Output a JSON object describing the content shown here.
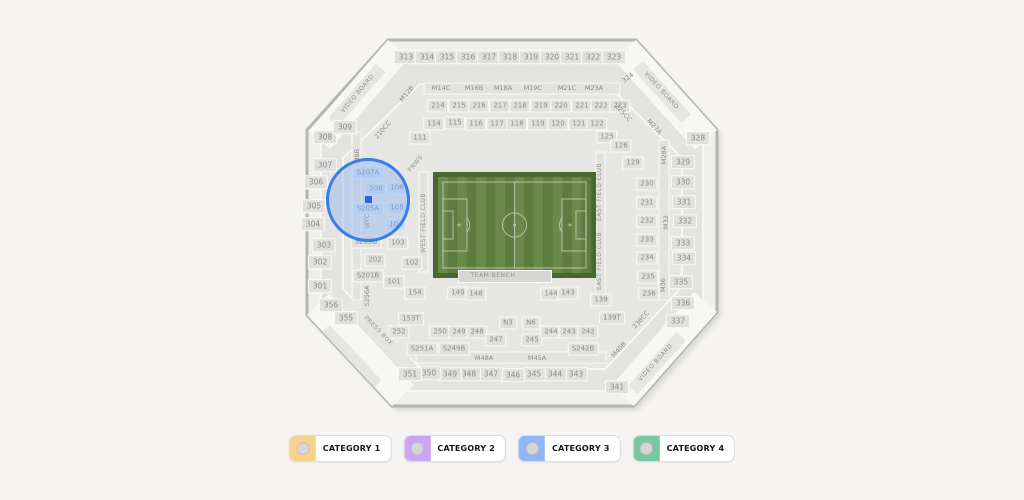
{
  "colors": {
    "page_bg": "#f5f4f2",
    "map_fill": "#efefed",
    "map_stroke": "#b4b4b2",
    "bowl_fill": "#e3e3e1",
    "bowl_fill2": "#e6e6e4",
    "aisle_white": "#f6f6f4",
    "corner_white": "#f7f7f5",
    "strip_fill": "#e2e2e0",
    "field_border": "#49682f",
    "stripe_dark": "#5e7c40",
    "stripe_light": "#6a8a4b",
    "field_line": "#c8d2ba",
    "bench_fill": "#d6d6d4",
    "highlight_stroke": "#3a7de6",
    "highlight_fill": "rgba(144,181,238,0.45)",
    "marker": "#2b66e0"
  },
  "legend": {
    "items": [
      {
        "label": "CATEGORY 1",
        "color": "#f8d18b"
      },
      {
        "label": "CATEGORY 2",
        "color": "#c9a6f3"
      },
      {
        "label": "CATEGORY 3",
        "color": "#90b6f6"
      },
      {
        "label": "CATEGORY 4",
        "color": "#77c8a0"
      }
    ],
    "y": 435
  },
  "map": {
    "outline": "388,40 636,40 717,130 717,312 634,406 392,406 307,315 307,130",
    "ring1": "397,62 626,62 703,141 703,302 624,391 400,391 321,305 321,141",
    "ring2": "420,84 607,84 682,158 682,287 605,369 421,369 343,289 343,158",
    "corner_bands": [
      "388,40 309,131 330,149 409,58",
      "636,40 717,130 695,150 614,60",
      "717,312 634,406 611,386 694,292",
      "307,315 392,406 414,385 329,294"
    ],
    "board_strips": [
      {
        "x": 357,
        "y": 95,
        "w": 72,
        "h": 13,
        "r": -49
      },
      {
        "x": 662,
        "y": 92,
        "w": 72,
        "h": 13,
        "r": 48
      },
      {
        "x": 657,
        "y": 363,
        "w": 72,
        "h": 13,
        "r": -48
      },
      {
        "x": 377,
        "y": 332,
        "w": 86,
        "h": 14,
        "r": 47
      },
      {
        "x": 352,
        "y": 356,
        "w": 76,
        "h": 10,
        "r": 47
      }
    ],
    "strips": [
      {
        "x": 424,
        "y": 83,
        "w": 196,
        "h": 11
      },
      {
        "x": 416,
        "y": 352,
        "w": 190,
        "h": 11
      },
      {
        "x": 419,
        "y": 172,
        "w": 9,
        "h": 100
      },
      {
        "x": 596,
        "y": 152,
        "w": 9,
        "h": 148
      },
      {
        "x": 659,
        "y": 140,
        "w": 10,
        "h": 160
      },
      {
        "x": 352,
        "y": 132,
        "w": 9,
        "h": 168
      }
    ],
    "field": {
      "x": 433,
      "y": 172,
      "w": 163,
      "h": 106,
      "stripes": 16
    },
    "bench": {
      "x": 458,
      "y": 270,
      "w": 92,
      "h": 11
    },
    "highlight": {
      "cx": 368,
      "cy": 200,
      "r": 42
    },
    "marker": {
      "x": 368,
      "y": 199,
      "size": 7
    },
    "labels": [
      {
        "t": "313",
        "x": 406,
        "y": 57,
        "ty": "boxb"
      },
      {
        "t": "314",
        "x": 427,
        "y": 57,
        "ty": "boxb"
      },
      {
        "t": "315",
        "x": 447,
        "y": 57,
        "ty": "boxb"
      },
      {
        "t": "316",
        "x": 468,
        "y": 57,
        "ty": "boxb"
      },
      {
        "t": "317",
        "x": 489,
        "y": 57,
        "ty": "boxb"
      },
      {
        "t": "318",
        "x": 510,
        "y": 57,
        "ty": "boxb"
      },
      {
        "t": "319",
        "x": 531,
        "y": 57,
        "ty": "boxb"
      },
      {
        "t": "320",
        "x": 552,
        "y": 57,
        "ty": "boxb"
      },
      {
        "t": "321",
        "x": 572,
        "y": 57,
        "ty": "boxb"
      },
      {
        "t": "322",
        "x": 593,
        "y": 57,
        "ty": "boxb"
      },
      {
        "t": "323",
        "x": 614,
        "y": 57,
        "ty": "boxb"
      },
      {
        "t": "324",
        "x": 628,
        "y": 78,
        "ty": "plain",
        "r": -38
      },
      {
        "t": "328",
        "x": 698,
        "y": 138,
        "ty": "boxb"
      },
      {
        "t": "329",
        "x": 683,
        "y": 162,
        "ty": "boxb"
      },
      {
        "t": "330",
        "x": 683,
        "y": 182,
        "ty": "boxb"
      },
      {
        "t": "331",
        "x": 684,
        "y": 202,
        "ty": "boxb"
      },
      {
        "t": "332",
        "x": 685,
        "y": 221,
        "ty": "boxb"
      },
      {
        "t": "333",
        "x": 683,
        "y": 243,
        "ty": "boxb"
      },
      {
        "t": "334",
        "x": 684,
        "y": 258,
        "ty": "boxb"
      },
      {
        "t": "335",
        "x": 681,
        "y": 282,
        "ty": "boxb"
      },
      {
        "t": "336",
        "x": 683,
        "y": 303,
        "ty": "boxb"
      },
      {
        "t": "337",
        "x": 678,
        "y": 321,
        "ty": "boxb"
      },
      {
        "t": "341",
        "x": 617,
        "y": 387,
        "ty": "boxb"
      },
      {
        "t": "343",
        "x": 576,
        "y": 374,
        "ty": "boxb"
      },
      {
        "t": "344",
        "x": 555,
        "y": 374,
        "ty": "boxb"
      },
      {
        "t": "345",
        "x": 534,
        "y": 374,
        "ty": "boxb"
      },
      {
        "t": "346",
        "x": 513,
        "y": 375,
        "ty": "boxb"
      },
      {
        "t": "347",
        "x": 491,
        "y": 374,
        "ty": "boxb"
      },
      {
        "t": "348",
        "x": 469,
        "y": 374,
        "ty": "boxb"
      },
      {
        "t": "349",
        "x": 450,
        "y": 374,
        "ty": "boxb"
      },
      {
        "t": "350",
        "x": 429,
        "y": 373,
        "ty": "boxb"
      },
      {
        "t": "351",
        "x": 410,
        "y": 374,
        "ty": "boxb"
      },
      {
        "t": "355",
        "x": 346,
        "y": 318,
        "ty": "boxb"
      },
      {
        "t": "356",
        "x": 331,
        "y": 305,
        "ty": "boxb"
      },
      {
        "t": "301",
        "x": 320,
        "y": 286,
        "ty": "boxb"
      },
      {
        "t": "302",
        "x": 320,
        "y": 262,
        "ty": "boxb"
      },
      {
        "t": "303",
        "x": 324,
        "y": 245,
        "ty": "boxb"
      },
      {
        "t": "304",
        "x": 313,
        "y": 224,
        "ty": "boxb"
      },
      {
        "t": "305",
        "x": 314,
        "y": 206,
        "ty": "boxb"
      },
      {
        "t": "306",
        "x": 316,
        "y": 182,
        "ty": "boxb"
      },
      {
        "t": "307",
        "x": 325,
        "y": 165,
        "ty": "boxb"
      },
      {
        "t": "308",
        "x": 325,
        "y": 137,
        "ty": "boxb"
      },
      {
        "t": "309",
        "x": 345,
        "y": 127,
        "ty": "boxb"
      },
      {
        "t": "214",
        "x": 438,
        "y": 106,
        "ty": "box"
      },
      {
        "t": "215",
        "x": 459,
        "y": 106,
        "ty": "box"
      },
      {
        "t": "216",
        "x": 479,
        "y": 106,
        "ty": "box"
      },
      {
        "t": "217",
        "x": 500,
        "y": 106,
        "ty": "box"
      },
      {
        "t": "218",
        "x": 520,
        "y": 106,
        "ty": "box"
      },
      {
        "t": "219",
        "x": 541,
        "y": 106,
        "ty": "box"
      },
      {
        "t": "220",
        "x": 561,
        "y": 106,
        "ty": "box"
      },
      {
        "t": "221",
        "x": 582,
        "y": 106,
        "ty": "box"
      },
      {
        "t": "222",
        "x": 601,
        "y": 106,
        "ty": "box"
      },
      {
        "t": "223",
        "x": 620,
        "y": 106,
        "ty": "box"
      },
      {
        "t": "114",
        "x": 434,
        "y": 124,
        "ty": "box"
      },
      {
        "t": "115",
        "x": 455,
        "y": 123,
        "ty": "box"
      },
      {
        "t": "116",
        "x": 476,
        "y": 124,
        "ty": "box"
      },
      {
        "t": "117",
        "x": 497,
        "y": 124,
        "ty": "box"
      },
      {
        "t": "118",
        "x": 517,
        "y": 124,
        "ty": "box"
      },
      {
        "t": "119",
        "x": 538,
        "y": 124,
        "ty": "box"
      },
      {
        "t": "120",
        "x": 558,
        "y": 124,
        "ty": "box"
      },
      {
        "t": "121",
        "x": 579,
        "y": 124,
        "ty": "box"
      },
      {
        "t": "122",
        "x": 597,
        "y": 124,
        "ty": "box"
      },
      {
        "t": "111",
        "x": 420,
        "y": 138,
        "ty": "box"
      },
      {
        "t": "125",
        "x": 607,
        "y": 137,
        "ty": "box"
      },
      {
        "t": "126",
        "x": 621,
        "y": 146,
        "ty": "box"
      },
      {
        "t": "129",
        "x": 633,
        "y": 163,
        "ty": "box"
      },
      {
        "t": "230",
        "x": 647,
        "y": 184,
        "ty": "box"
      },
      {
        "t": "231",
        "x": 647,
        "y": 203,
        "ty": "box"
      },
      {
        "t": "232",
        "x": 647,
        "y": 221,
        "ty": "box"
      },
      {
        "t": "233",
        "x": 647,
        "y": 240,
        "ty": "box"
      },
      {
        "t": "234",
        "x": 647,
        "y": 258,
        "ty": "box"
      },
      {
        "t": "235",
        "x": 648,
        "y": 277,
        "ty": "box"
      },
      {
        "t": "236",
        "x": 649,
        "y": 294,
        "ty": "box"
      },
      {
        "t": "139",
        "x": 601,
        "y": 300,
        "ty": "box"
      },
      {
        "t": "139T",
        "x": 612,
        "y": 318,
        "ty": "box"
      },
      {
        "t": "149",
        "x": 458,
        "y": 293,
        "ty": "box"
      },
      {
        "t": "148",
        "x": 476,
        "y": 294,
        "ty": "box"
      },
      {
        "t": "144",
        "x": 551,
        "y": 294,
        "ty": "box"
      },
      {
        "t": "143",
        "x": 568,
        "y": 293,
        "ty": "box"
      },
      {
        "t": "154",
        "x": 415,
        "y": 293,
        "ty": "box"
      },
      {
        "t": "153T",
        "x": 411,
        "y": 319,
        "ty": "box"
      },
      {
        "t": "252",
        "x": 399,
        "y": 332,
        "ty": "box"
      },
      {
        "t": "250",
        "x": 440,
        "y": 332,
        "ty": "box"
      },
      {
        "t": "249",
        "x": 459,
        "y": 332,
        "ty": "box"
      },
      {
        "t": "248",
        "x": 477,
        "y": 332,
        "ty": "box"
      },
      {
        "t": "247",
        "x": 496,
        "y": 340,
        "ty": "box"
      },
      {
        "t": "245",
        "x": 532,
        "y": 340,
        "ty": "box"
      },
      {
        "t": "244",
        "x": 551,
        "y": 332,
        "ty": "box"
      },
      {
        "t": "243",
        "x": 569,
        "y": 332,
        "ty": "box"
      },
      {
        "t": "242",
        "x": 588,
        "y": 332,
        "ty": "box"
      },
      {
        "t": "N3",
        "x": 508,
        "y": 323,
        "ty": "box"
      },
      {
        "t": "N6",
        "x": 531,
        "y": 323,
        "ty": "box"
      },
      {
        "t": "101",
        "x": 394,
        "y": 282,
        "ty": "box"
      },
      {
        "t": "102",
        "x": 412,
        "y": 263,
        "ty": "box"
      },
      {
        "t": "103",
        "x": 398,
        "y": 243,
        "ty": "box"
      },
      {
        "t": "202",
        "x": 375,
        "y": 260,
        "ty": "box"
      },
      {
        "t": "S203B",
        "x": 366,
        "y": 242,
        "ty": "box"
      },
      {
        "t": "S201B",
        "x": 368,
        "y": 276,
        "ty": "box"
      },
      {
        "t": "S251A",
        "x": 422,
        "y": 349,
        "ty": "box"
      },
      {
        "t": "S249B",
        "x": 454,
        "y": 349,
        "ty": "box"
      },
      {
        "t": "S242B",
        "x": 583,
        "y": 349,
        "ty": "box"
      },
      {
        "t": "S207A",
        "x": 368,
        "y": 173,
        "ty": "hl"
      },
      {
        "t": "206",
        "x": 376,
        "y": 189,
        "ty": "hl"
      },
      {
        "t": "106",
        "x": 397,
        "y": 188,
        "ty": "hl"
      },
      {
        "t": "S205A",
        "x": 368,
        "y": 209,
        "ty": "hl"
      },
      {
        "t": "105",
        "x": 397,
        "y": 208,
        "ty": "hl"
      },
      {
        "t": "104",
        "x": 396,
        "y": 225,
        "ty": "hl"
      },
      {
        "t": "M14C",
        "x": 441,
        "y": 88,
        "ty": "plain"
      },
      {
        "t": "M16B",
        "x": 474,
        "y": 88,
        "ty": "plain"
      },
      {
        "t": "M18A",
        "x": 503,
        "y": 88,
        "ty": "plain"
      },
      {
        "t": "M19C",
        "x": 533,
        "y": 88,
        "ty": "plain"
      },
      {
        "t": "M21C",
        "x": 567,
        "y": 88,
        "ty": "plain"
      },
      {
        "t": "M23A",
        "x": 594,
        "y": 88,
        "ty": "plain"
      },
      {
        "t": "M48A",
        "x": 484,
        "y": 358,
        "ty": "plain"
      },
      {
        "t": "M45A",
        "x": 537,
        "y": 358,
        "ty": "plain"
      },
      {
        "t": "M12B",
        "x": 407,
        "y": 94,
        "ty": "diag",
        "r": -50
      },
      {
        "t": "210CC",
        "x": 383,
        "y": 130,
        "ty": "diag",
        "r": -50
      },
      {
        "t": "225CC",
        "x": 623,
        "y": 113,
        "ty": "diag",
        "r": 48
      },
      {
        "t": "M27A",
        "x": 654,
        "y": 127,
        "ty": "diag",
        "r": 48
      },
      {
        "t": "M40B",
        "x": 619,
        "y": 350,
        "ty": "diag",
        "r": -48
      },
      {
        "t": "238CC",
        "x": 641,
        "y": 320,
        "ty": "diag",
        "r": -48
      },
      {
        "t": "M28A",
        "x": 664,
        "y": 155,
        "ty": "vert"
      },
      {
        "t": "M32",
        "x": 666,
        "y": 222,
        "ty": "vert"
      },
      {
        "t": "M36",
        "x": 663,
        "y": 285,
        "ty": "vert"
      },
      {
        "t": "M8B",
        "x": 357,
        "y": 156,
        "ty": "vert"
      },
      {
        "t": "S256A",
        "x": 367,
        "y": 296,
        "ty": "vert"
      },
      {
        "t": "WFC",
        "x": 367,
        "y": 221,
        "ty": "vert"
      },
      {
        "t": "WEST FIELD CLUB",
        "x": 424,
        "y": 223,
        "ty": "vstatic"
      },
      {
        "t": "EAST FIELD CLUB",
        "x": 600,
        "y": 192,
        "ty": "vstatic"
      },
      {
        "t": "EAST FIELD CLUB",
        "x": 600,
        "y": 261,
        "ty": "vstatic"
      },
      {
        "t": "FNWS",
        "x": 416,
        "y": 164,
        "ty": "dstatic",
        "r": -50
      },
      {
        "t": "PRESS BOX",
        "x": 378,
        "y": 331,
        "ty": "dstatic",
        "r": 46
      },
      {
        "t": "VIDEO BOARD",
        "x": 358,
        "y": 94,
        "ty": "dstatic",
        "r": -50
      },
      {
        "t": "VIDEO BOARD",
        "x": 661,
        "y": 91,
        "ty": "dstatic",
        "r": 48
      },
      {
        "t": "VIDEO BOARD",
        "x": 656,
        "y": 363,
        "ty": "dstatic",
        "r": -48
      },
      {
        "t": "TEAM BENCH",
        "x": 493,
        "y": 276,
        "ty": "static"
      }
    ]
  }
}
